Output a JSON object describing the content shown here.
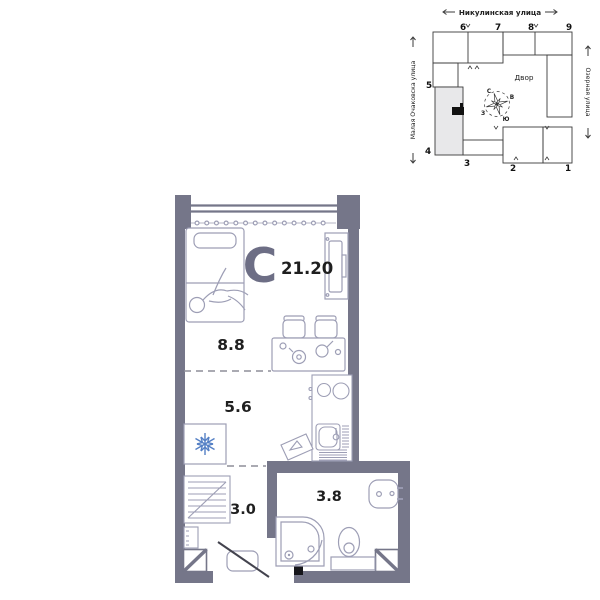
{
  "site_plan": {
    "streets": {
      "top": "Никулинская улица",
      "left": "Малая Очаковска улица",
      "right": "Озерная улица"
    },
    "courtyard_label": "Двор",
    "building_numbers": [
      "1",
      "2",
      "3",
      "4",
      "5",
      "6",
      "7",
      "8",
      "9"
    ],
    "compass": {
      "n": "С",
      "e": "В",
      "w": "З",
      "s": "Ю"
    }
  },
  "floor_plan": {
    "type_label": "С",
    "total_area": "21.20",
    "rooms": [
      {
        "name": "living-room",
        "area": "8.8"
      },
      {
        "name": "kitchen",
        "area": "5.6"
      },
      {
        "name": "hallway",
        "area": "3.0"
      },
      {
        "name": "bathroom",
        "area": "3.8"
      }
    ]
  },
  "colors": {
    "wall": "#757689",
    "furniture_line": "#9d9eb5",
    "snowflake_blue": "#5580c5",
    "site_highlight": "#e8e8ea",
    "text": "#1f1f1f"
  }
}
